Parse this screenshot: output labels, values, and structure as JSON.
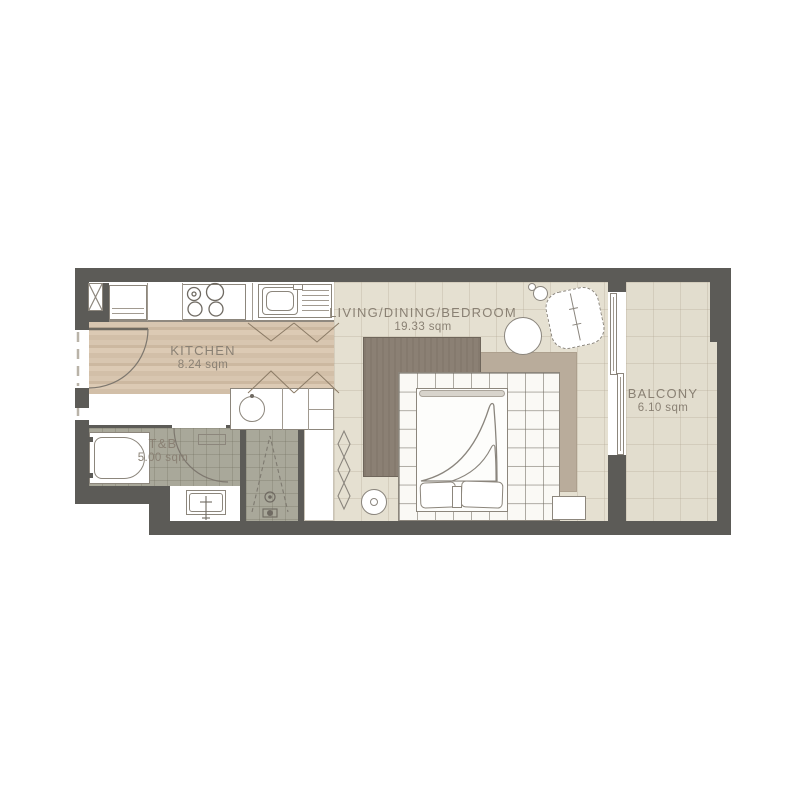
{
  "floorplan": {
    "rooms": {
      "kitchen": {
        "label": "KITCHEN",
        "area": "8.24 sqm"
      },
      "toilet_bath": {
        "label": "T&B",
        "area": "5.00 sqm"
      },
      "living_dining_bedroom": {
        "label": "LIVING/DINING/BEDROOM",
        "area": "19.33 sqm"
      },
      "balcony": {
        "label": "BALCONY",
        "area": "6.10 sqm"
      }
    },
    "colors": {
      "wall": "#5c5b57",
      "wood_floor": "#d5c3ad",
      "tile_floor": "#e5e0d1",
      "bath_floor": "#a9a89a",
      "rug_dark": "#8b8074",
      "rug_light": "#b9ac9b",
      "label_text": "#8a8174"
    },
    "fixture_icons": [
      "refrigerator",
      "stove-burners",
      "kitchen-sink",
      "shaft-column",
      "entry-door-swing",
      "vanity-basin",
      "bathtub",
      "toilet",
      "shower-drain",
      "closet-accordion",
      "bed-platform",
      "mattress",
      "pillows",
      "blanket",
      "rug-dark",
      "rug-light",
      "dining-table",
      "lounge-chair",
      "floor-lamp",
      "side-table",
      "sliding-glass-door"
    ]
  }
}
